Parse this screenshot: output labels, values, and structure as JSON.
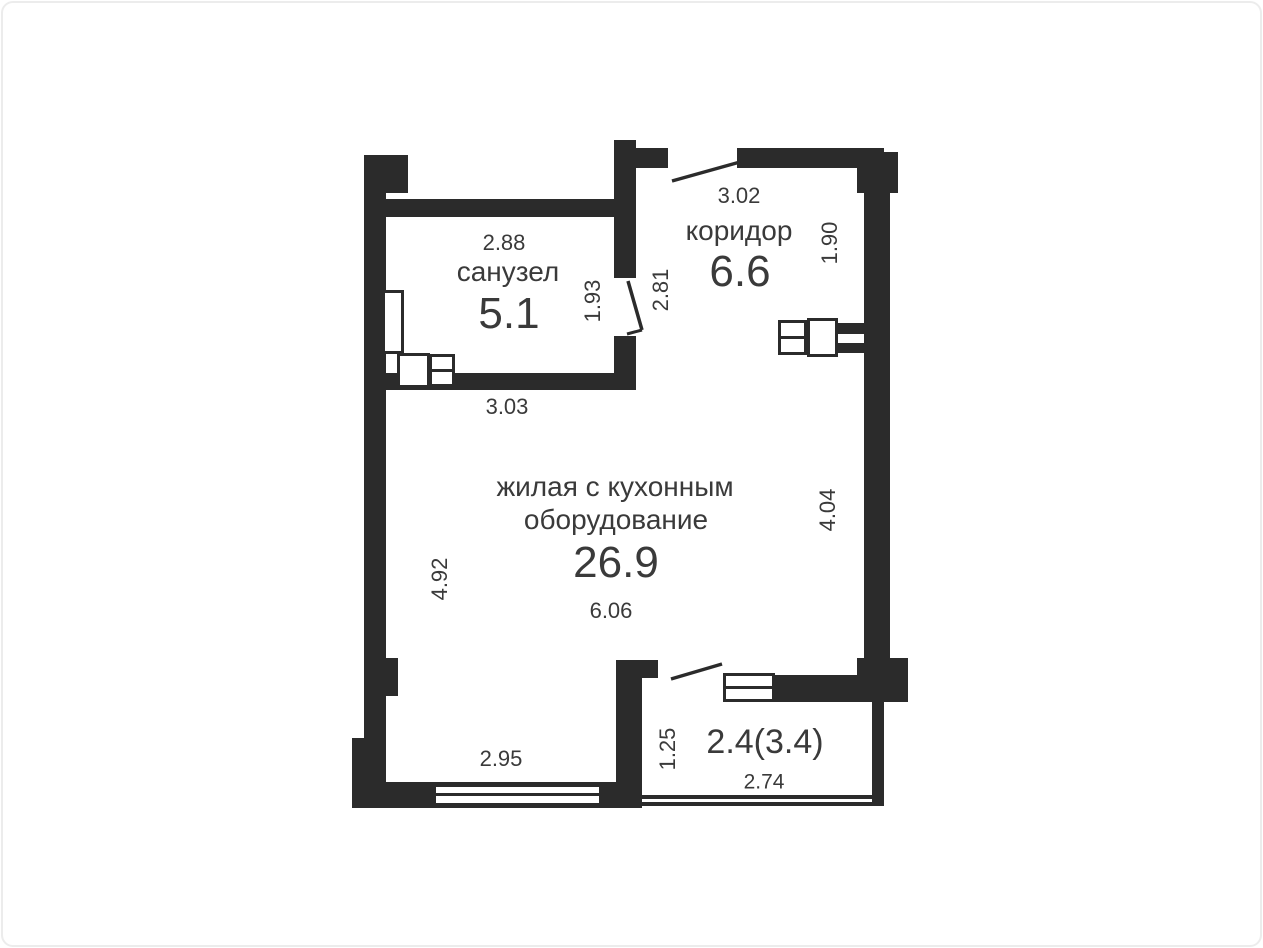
{
  "colors": {
    "wall": "#2b2b2b",
    "text": "#3a3a3a",
    "background": "#ffffff",
    "frame_border": "#ececec"
  },
  "plan": {
    "rooms": [
      {
        "id": "bathroom",
        "name": "санузел",
        "area": "5.1"
      },
      {
        "id": "corridor",
        "name": "коридор",
        "area": "6.6"
      },
      {
        "id": "living",
        "name_line1": "жилая с кухонным",
        "name_line2": "оборудование",
        "area": "26.9"
      },
      {
        "id": "balcony",
        "area": "2.4(3.4)"
      }
    ],
    "dimensions": {
      "bathroom_top": "2.88",
      "bathroom_right": "1.93",
      "bathroom_door": "2.81",
      "bathroom_bottom": "3.03",
      "corridor_top": "3.02",
      "corridor_right": "1.90",
      "living_left": "4.92",
      "living_right": "4.04",
      "living_bottom": "6.06",
      "bottom_wall": "2.95",
      "balcony_left": "1.25",
      "balcony_bottom": "2.74"
    }
  }
}
